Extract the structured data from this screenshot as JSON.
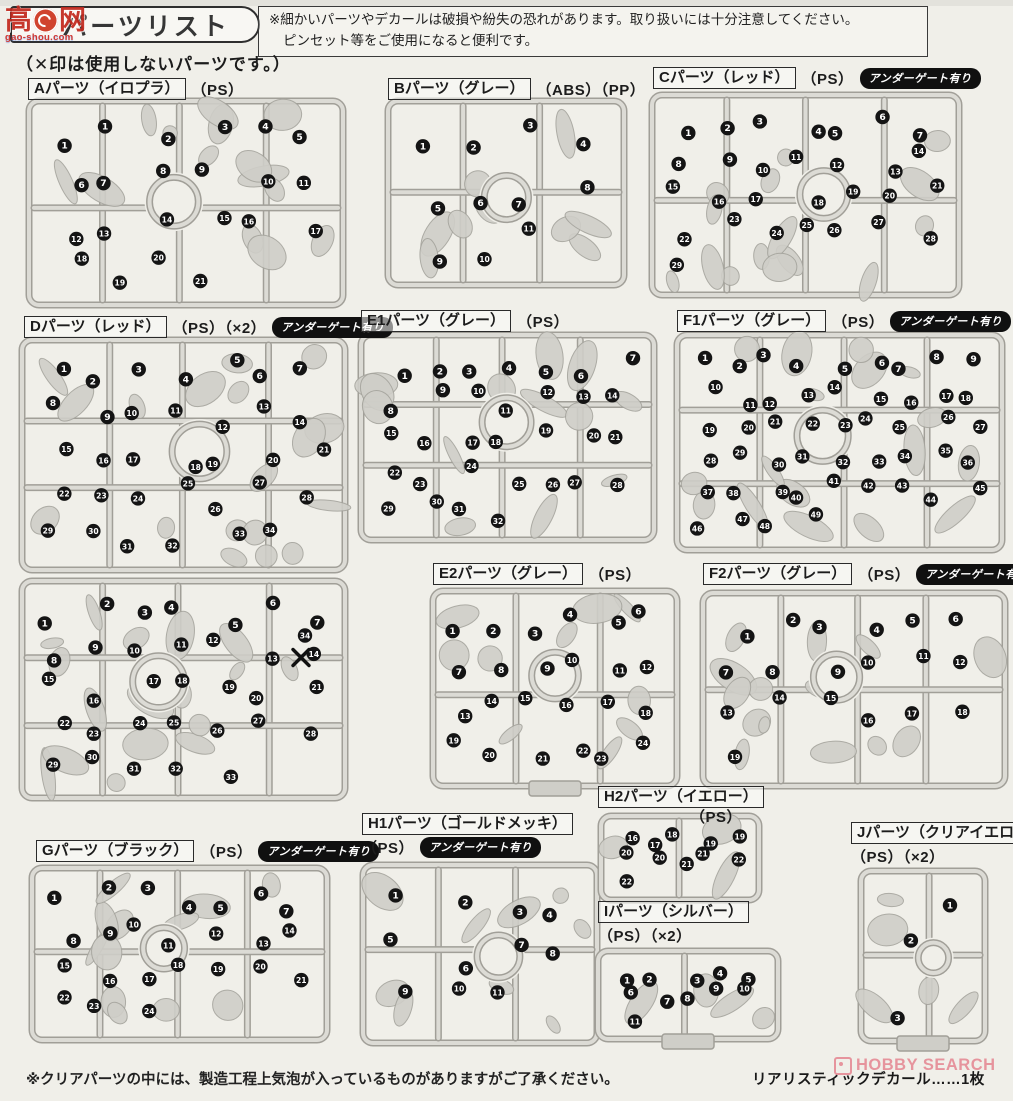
{
  "header": {
    "title": "パーツリスト",
    "notice_line1": "※細かいパーツやデカールは破損や紛失の恐れがあります。取り扱いには十分注意してください。",
    "notice_line2": "ピンセット等をご使用になると便利です。",
    "x_note": "（✕印は使用しないパーツです。）"
  },
  "badges": {
    "undergate": "アンダーゲート有り"
  },
  "watermark_top": {
    "char1": "高",
    "char2": "网",
    "url_text": "gao-shou.com"
  },
  "watermark_bottom": {
    "text": "HOBBY SEARCH"
  },
  "footer": {
    "clear_note": "※クリアパーツの中には、製造工程上気泡が入っているものがありますがご了承ください。",
    "decal_text": "リアリスティックデカール……1枚"
  },
  "colors": {
    "paper": "#f0efe9",
    "sprue_edge": "#a19f98",
    "sprue_core": "#dcdbd5",
    "part_fill": "#cfcec8",
    "badge_black": "#141414",
    "watermark_red": "#c32a1f",
    "hobby_pink": "#e05c6e"
  },
  "sections": [
    {
      "id": "A",
      "label": "Aパーツ（イロプラ）",
      "material": "（PS）",
      "undergate": false,
      "runners": 1,
      "numbers": [
        1,
        1,
        2,
        3,
        4,
        5,
        6,
        7,
        8,
        9,
        10,
        11,
        12,
        13,
        14,
        15,
        16,
        17,
        18,
        19,
        20,
        21
      ]
    },
    {
      "id": "B",
      "label": "Bパーツ（グレー）",
      "material": "（ABS）（PP）",
      "undergate": false,
      "runners": 1,
      "numbers": [
        1,
        2,
        3,
        4,
        5,
        6,
        7,
        8,
        9,
        10,
        11
      ]
    },
    {
      "id": "C",
      "label": "Cパーツ（レッド）",
      "material": "（PS）",
      "undergate": true,
      "runners": 1,
      "numbers": [
        1,
        2,
        3,
        4,
        5,
        6,
        7,
        8,
        9,
        10,
        11,
        12,
        13,
        14,
        15,
        16,
        17,
        18,
        19,
        20,
        21,
        22,
        23,
        24,
        25,
        26,
        27,
        28,
        29
      ]
    },
    {
      "id": "D",
      "label": "Dパーツ（レッド）",
      "material": "（PS）（×2）",
      "undergate": true,
      "runners": 2,
      "numbers": [
        1,
        2,
        3,
        4,
        5,
        6,
        7,
        8,
        9,
        10,
        11,
        12,
        13,
        14,
        15,
        16,
        17,
        18,
        19,
        20,
        21,
        22,
        23,
        24,
        25,
        26,
        27,
        28,
        29,
        30,
        31,
        32,
        33,
        34
      ],
      "crossed_number": 34,
      "crossed_runner": 2
    },
    {
      "id": "E1",
      "label": "E1パーツ（グレー）",
      "material": "（PS）",
      "undergate": false,
      "runners": 1,
      "numbers": [
        1,
        2,
        3,
        4,
        5,
        6,
        7,
        8,
        9,
        10,
        11,
        12,
        13,
        14,
        15,
        16,
        17,
        18,
        19,
        20,
        21,
        22,
        23,
        24,
        25,
        26,
        27,
        28,
        29,
        30,
        31,
        32
      ]
    },
    {
      "id": "F1",
      "label": "F1パーツ（グレー）",
      "material": "（PS）",
      "undergate": true,
      "runners": 1,
      "numbers": [
        1,
        2,
        3,
        4,
        5,
        6,
        7,
        8,
        9,
        10,
        11,
        12,
        13,
        14,
        15,
        16,
        17,
        18,
        19,
        20,
        21,
        22,
        23,
        24,
        25,
        26,
        27,
        28,
        29,
        30,
        31,
        32,
        33,
        34,
        35,
        36,
        37,
        38,
        39,
        40,
        41,
        42,
        43,
        44,
        45,
        46,
        47,
        48,
        49
      ]
    },
    {
      "id": "E2",
      "label": "E2パーツ（グレー）",
      "material": "（PS）",
      "undergate": false,
      "runners": 1,
      "numbers": [
        1,
        2,
        3,
        4,
        5,
        6,
        7,
        8,
        9,
        10,
        11,
        12,
        13,
        14,
        15,
        16,
        17,
        18,
        19,
        20,
        21,
        22,
        23,
        24
      ]
    },
    {
      "id": "F2",
      "label": "F2パーツ（グレー）",
      "material": "（PS）",
      "undergate": true,
      "runners": 1,
      "numbers": [
        1,
        2,
        3,
        4,
        5,
        6,
        7,
        8,
        9,
        10,
        11,
        12,
        13,
        14,
        15,
        16,
        17,
        18,
        19
      ]
    },
    {
      "id": "G",
      "label": "Gパーツ（ブラック）",
      "material": "（PS）",
      "undergate": true,
      "runners": 1,
      "numbers": [
        1,
        2,
        3,
        4,
        5,
        6,
        7,
        8,
        9,
        10,
        11,
        12,
        13,
        14,
        15,
        16,
        17,
        18,
        19,
        20,
        21,
        22,
        23,
        24
      ]
    },
    {
      "id": "H1",
      "label": "H1パーツ（ゴールドメッキ）",
      "material": "（PS）",
      "undergate": true,
      "runners": 1,
      "numbers": [
        1,
        2,
        3,
        4,
        5,
        6,
        7,
        8,
        9,
        10,
        11
      ]
    },
    {
      "id": "H2",
      "label": "H2パーツ（イエロー）",
      "material": "（PS）",
      "undergate": false,
      "runners": 1,
      "numbers": [
        16,
        17,
        18,
        19,
        19,
        20,
        20,
        21,
        21,
        22,
        22
      ]
    },
    {
      "id": "I",
      "label": "Iパーツ（シルバー）",
      "material": "（PS）（×2）",
      "undergate": false,
      "runners": 1,
      "numbers": [
        1,
        2,
        3,
        4,
        5,
        6,
        7,
        8,
        9,
        10,
        11
      ]
    },
    {
      "id": "J",
      "label": "Jパーツ（クリアイエロー）",
      "material": "（PS）（×2）",
      "undergate": false,
      "runners": 1,
      "numbers": [
        1,
        2,
        3
      ]
    }
  ]
}
